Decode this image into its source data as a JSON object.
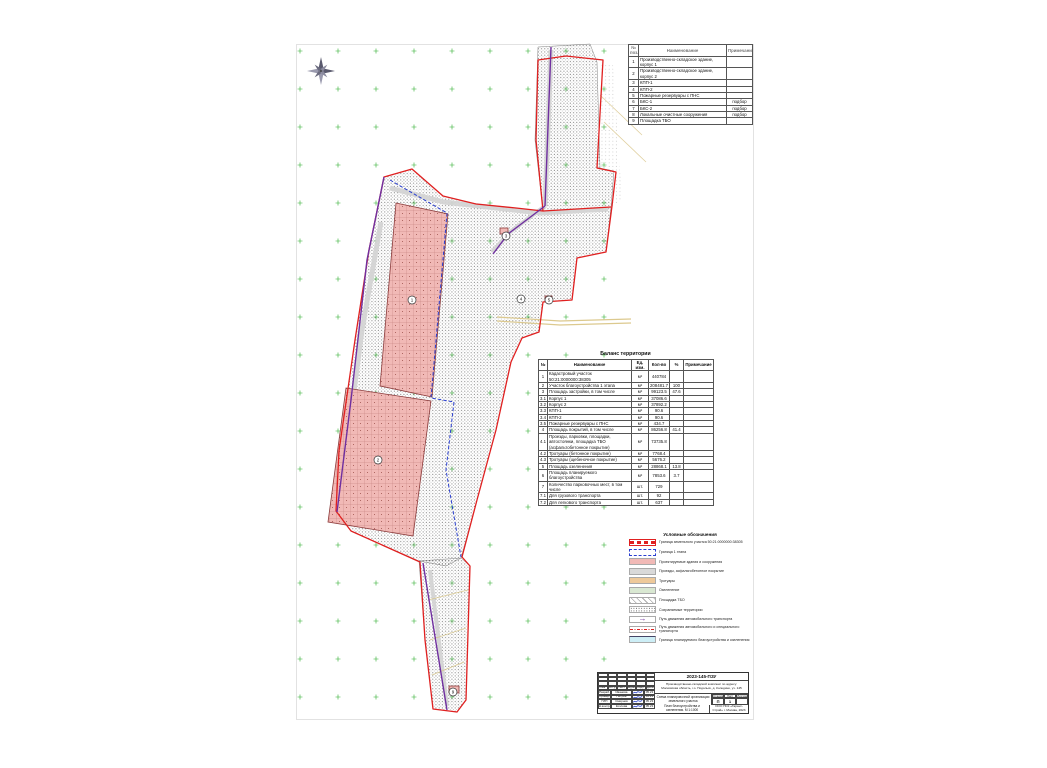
{
  "colors": {
    "boundary_red": "#e02020",
    "stage_blue": "#2a3fd0",
    "route_purple": "#7030a0",
    "building_pink": "#f1b9b6",
    "grid_green": "#2fae2f",
    "road_gray": "#d4d4d4",
    "existing_road_tan": "#dcc98e",
    "legend_cyan": "#cdeef6"
  },
  "explication": {
    "header": [
      "№ поз.",
      "Наименование",
      "Примечание"
    ],
    "rows": [
      [
        "1",
        "Производственно-складское здание, корпус 1",
        ""
      ],
      [
        "2",
        "Производственно-складское здание, корпус 2",
        ""
      ],
      [
        "3",
        "КПП-1",
        ""
      ],
      [
        "4",
        "КПП-2",
        ""
      ],
      [
        "5",
        "Пожарные резервуары с ПНС",
        ""
      ],
      [
        "6",
        "БКС-1",
        "подбор"
      ],
      [
        "7",
        "БКС-2",
        "подбор"
      ],
      [
        "8",
        "Локальные очистные сооружения",
        "подбор"
      ],
      [
        "9",
        "Площадка ТБО",
        ""
      ]
    ]
  },
  "balance": {
    "title": "Баланс территории",
    "header": [
      "№",
      "Наименование",
      "Ед. изм.",
      "Кол-во",
      "%",
      "Примечание"
    ],
    "rows": [
      [
        "1",
        "Кадастровый участок 50:21:0000000:38305",
        "м²",
        "440784",
        "",
        ""
      ],
      [
        "2",
        "Участок благоустройства 1 этапа",
        "м²",
        "208481.7",
        "100",
        ""
      ],
      [
        "3",
        "Площадь застройки, в том числе",
        "м²",
        "99123.5",
        "47.6",
        ""
      ],
      [
        "3.1",
        "Корпус 1",
        "м²",
        "37086.6",
        "",
        ""
      ],
      [
        "3.2",
        "Корпус 2",
        "м²",
        "37892.2",
        "",
        ""
      ],
      [
        "3.3",
        "КПП-1",
        "м²",
        "90.6",
        "",
        ""
      ],
      [
        "3.4",
        "КПП-2",
        "м²",
        "90.6",
        "",
        ""
      ],
      [
        "3.5",
        "Пожарные резервуары с ПНС",
        "м²",
        "434.7",
        "",
        ""
      ],
      [
        "4",
        "Площадь покрытий, в том числе",
        "м²",
        "86256.8",
        "41.4",
        ""
      ],
      [
        "4.1",
        "Проезды, парковки, площадки, автостоянки, площадка ТБО (асфальтобетонное покрытие)",
        "м²",
        "73735.8",
        "",
        ""
      ],
      [
        "4.2",
        "Тротуары (бетонное покрытие)",
        "м²",
        "7768.4",
        "",
        ""
      ],
      [
        "4.3",
        "Тротуары (щебеночное покрытие)",
        "м²",
        "5676.2",
        "",
        ""
      ],
      [
        "5",
        "Площадь озеленения",
        "м²",
        "28868.1",
        "13.8",
        ""
      ],
      [
        "6",
        "Площадь планируемого благоустройства",
        "м²",
        "7853.6",
        "3.7",
        ""
      ],
      [
        "7",
        "Количество парковочных мест, в том числе",
        "шт.",
        "729",
        "",
        ""
      ],
      [
        "7.1",
        "Для грузового транспорта",
        "шт.",
        "92",
        "",
        ""
      ],
      [
        "7.2",
        "Для легкового транспорта",
        "шт.",
        "637",
        "",
        ""
      ]
    ]
  },
  "legend": {
    "title": "Условные обозначения",
    "items": [
      {
        "swatch": "boundary-red",
        "label": "Граница земельного участка 50:21:0000000:38305"
      },
      {
        "swatch": "boundary-blue",
        "label": "Граница 1 этапа"
      },
      {
        "swatch": "pink",
        "label": "Проектируемые здания и сооружения"
      },
      {
        "swatch": "gray",
        "label": "Проезды, асфальтобетонное покрытие"
      },
      {
        "swatch": "tan",
        "label": "Тротуары"
      },
      {
        "swatch": "green",
        "label": "Озеленение"
      },
      {
        "swatch": "hatch",
        "label": "Площадка ТБО"
      },
      {
        "swatch": "stipple",
        "label": "Сохраняемые территории"
      },
      {
        "swatch": "route-purple",
        "label": "Путь движения автомобильного транспорта",
        "glyph": "→"
      },
      {
        "swatch": "route-red",
        "label": "Путь движения автомобильного и специального транспорта"
      },
      {
        "swatch": "cyan",
        "label": "Граница планируемого благоустройства и озеленения"
      }
    ]
  },
  "stamp": {
    "doc_code": "2023-145-ПЗУ",
    "doc_code_right": "2023-145-ПЗУ",
    "project": "Производственно-складской комплекс по адресу: Московская область, г.о. Подольск, д. Коледино, уч. 145",
    "cols": [
      "Изм.",
      "Кол.уч",
      "Лист",
      "№док.",
      "Подп.",
      "Дата"
    ],
    "sign_rows": [
      {
        "role": "Разраб.",
        "name": "Иванова",
        "date": "05.23"
      },
      {
        "role": "Провер.",
        "name": "Петров",
        "date": "05.23"
      },
      {
        "role": "ГИП",
        "name": "Смирнов",
        "date": "05.23"
      },
      {
        "role": "Н.контр.",
        "name": "Козлова",
        "date": "05.23"
      }
    ],
    "title1": "Схема планировочной организации земельного участка",
    "title2": "План благоустройства и озеленения. М 1:1000",
    "stage_label": "Стадия",
    "sheet_label": "Лист",
    "sheets_label": "Листов",
    "stage": "П",
    "sheet": "1",
    "sheets": "",
    "company": "ООО ПСК «Гарант-Строй» г. Москва, 2023"
  },
  "map": {
    "markers": [
      {
        "x": 412,
        "y": 300,
        "label": "1"
      },
      {
        "x": 378,
        "y": 460,
        "label": "2"
      },
      {
        "x": 506,
        "y": 236,
        "label": "3"
      },
      {
        "x": 521,
        "y": 299,
        "label": "4"
      },
      {
        "x": 549,
        "y": 300,
        "label": "5"
      },
      {
        "x": 453,
        "y": 692,
        "label": "9"
      }
    ]
  }
}
